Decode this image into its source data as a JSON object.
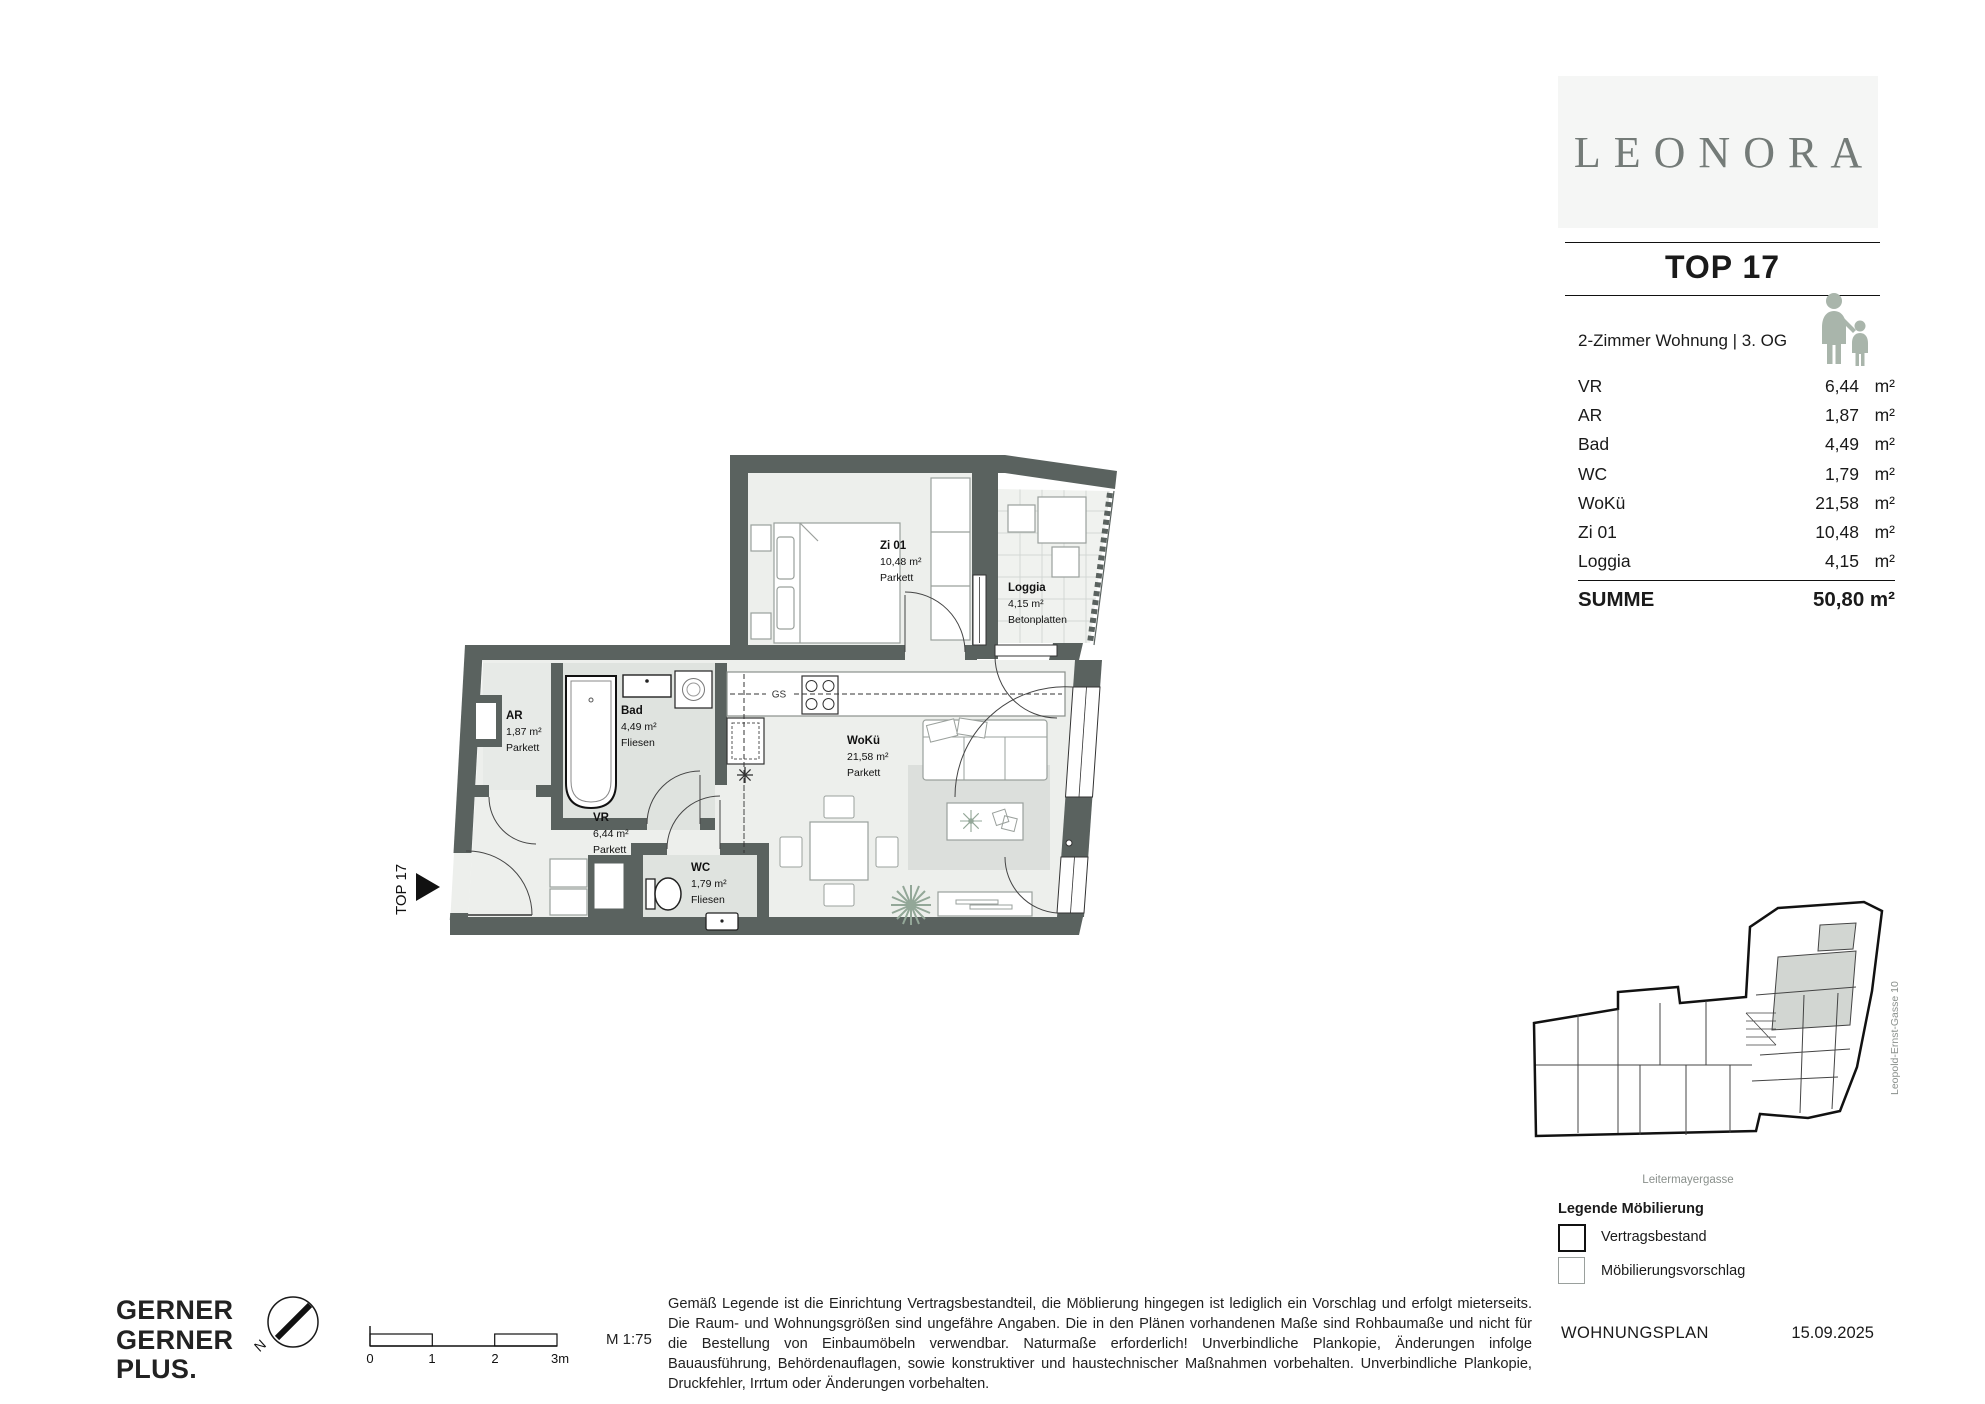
{
  "header": {
    "project": "LEONORA",
    "top": "TOP 17",
    "subtitle": "2-Zimmer Wohnung | 3. OG"
  },
  "area_table": {
    "rows": [
      {
        "room": "VR",
        "value": "6,44",
        "unit": "m²"
      },
      {
        "room": "AR",
        "value": "1,87",
        "unit": "m²"
      },
      {
        "room": "Bad",
        "value": "4,49",
        "unit": "m²"
      },
      {
        "room": "WC",
        "value": "1,79",
        "unit": "m²"
      },
      {
        "room": "WoKü",
        "value": "21,58",
        "unit": "m²"
      },
      {
        "room": "Zi 01",
        "value": "10,48",
        "unit": "m²"
      },
      {
        "room": "Loggia",
        "value": "4,15",
        "unit": "m²"
      }
    ],
    "total_label": "SUMME",
    "total_value": "50,80 m²"
  },
  "floor_plan": {
    "entrance_label": "TOP 17",
    "kitchen_dishwasher_label": "GS",
    "rooms": [
      {
        "name": "Zi 01",
        "area": "10,48 m²",
        "floor": "Parkett"
      },
      {
        "name": "Loggia",
        "area": "4,15 m²",
        "floor": "Betonplatten"
      },
      {
        "name": "AR",
        "area": "1,87 m²",
        "floor": "Parkett"
      },
      {
        "name": "Bad",
        "area": "4,49 m²",
        "floor": "Fliesen"
      },
      {
        "name": "WoKü",
        "area": "21,58 m²",
        "floor": "Parkett"
      },
      {
        "name": "VR",
        "area": "6,44 m²",
        "floor": "Parkett"
      },
      {
        "name": "WC",
        "area": "1,79 m²",
        "floor": "Fliesen"
      }
    ]
  },
  "site_plan": {
    "street_bottom": "Leitermayergasse",
    "street_side": "Leopold-Ernst-Gasse 10"
  },
  "legend": {
    "title": "Legende Möbilierung",
    "items": [
      {
        "label": "Vertragsbestand"
      },
      {
        "label": "Möbilierungsvorschlag"
      }
    ]
  },
  "footer": {
    "architect_line1": "GERNER",
    "architect_line2": "GERNER",
    "architect_line3": "PLUS.",
    "scale_ticks": [
      "0",
      "1",
      "2",
      "3m"
    ],
    "scale_label": "M 1:75",
    "doc_type": "WOHNUNGSPLAN",
    "date": "15.09.2025",
    "disclaimer": "Gemäß Legende ist die Einrichtung Vertragsbestandteil, die Möblierung hingegen ist lediglich ein Vorschlag und erfolgt mieterseits. Die Raum- und Wohnungsgrößen sind ungefähre Angaben. Die in den Plänen vorhandenen Maße sind Rohbaumaße und nicht für die Bestellung von Einbaumöbeln verwendbar. Naturmaße erforderlich! Unverbindliche Plankopie, Änderungen infolge Bauausführung, Behördenauflagen, sowie konstruktiver und haustechnischer Maßnahmen vorbehalten. Unverbindliche Plankopie, Druckfehler, Irrtum oder Änderungen vorbehalten."
  },
  "colors": {
    "wall": "#5a625f",
    "sage": "#a9b5ab",
    "logo_gray": "#747b78"
  }
}
